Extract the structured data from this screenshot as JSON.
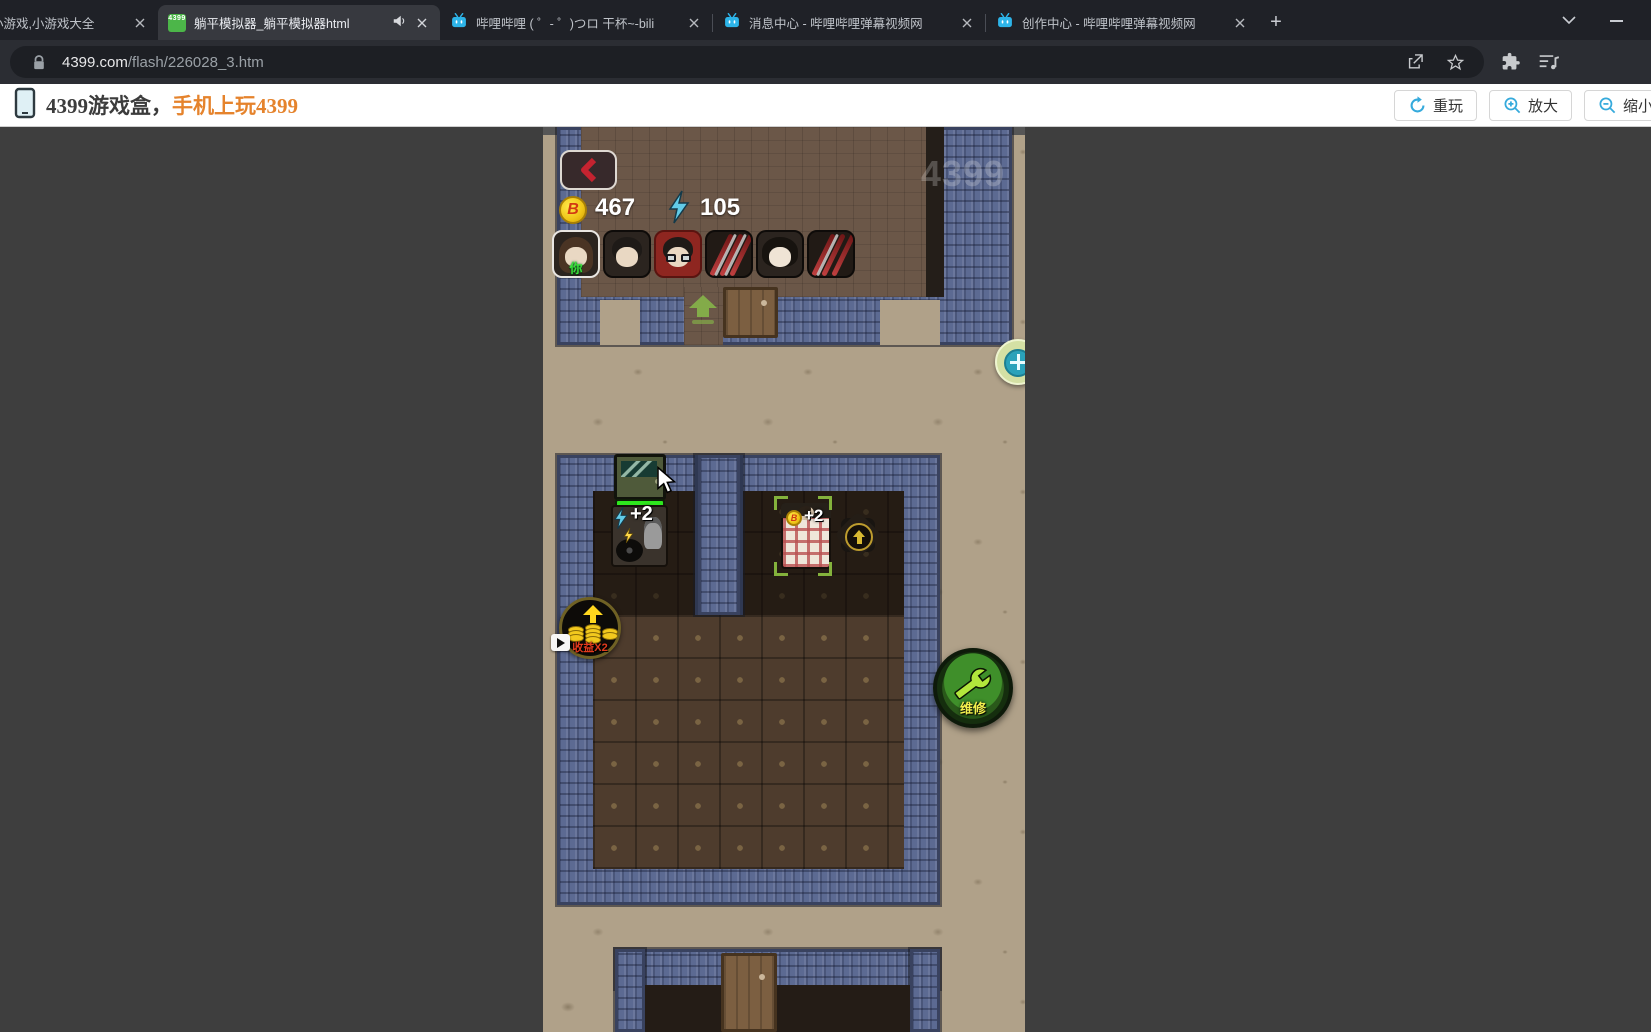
{
  "browser": {
    "tabs": [
      {
        "title": "9小游戏,小游戏大全"
      },
      {
        "title": "躺平模拟器_躺平模拟器html"
      },
      {
        "title": "哔哩哔哩 ( ゜- ゜)つロ 干杯~-bili"
      },
      {
        "title": "消息中心 - 哔哩哔哩弹幕视频网"
      },
      {
        "title": "创作中心 - 哔哩哔哩弹幕视频网"
      }
    ],
    "new_tab_label": "+",
    "url_domain": "4399.com",
    "url_path": "/flash/226028_3.htm"
  },
  "game_header": {
    "brand": "4399游戏盒，",
    "brand_highlight": "手机上玩4399",
    "replay": "重玩",
    "zoom_in": "放大",
    "zoom_out": "缩小"
  },
  "hud": {
    "coin_letter": "B",
    "coins": "467",
    "energy": "105",
    "you": "你",
    "watermark": "4399"
  },
  "world": {
    "energy_gain": "+2",
    "coin_gain": "+2",
    "boost_label": "收益X2",
    "repair_label": "维修"
  }
}
